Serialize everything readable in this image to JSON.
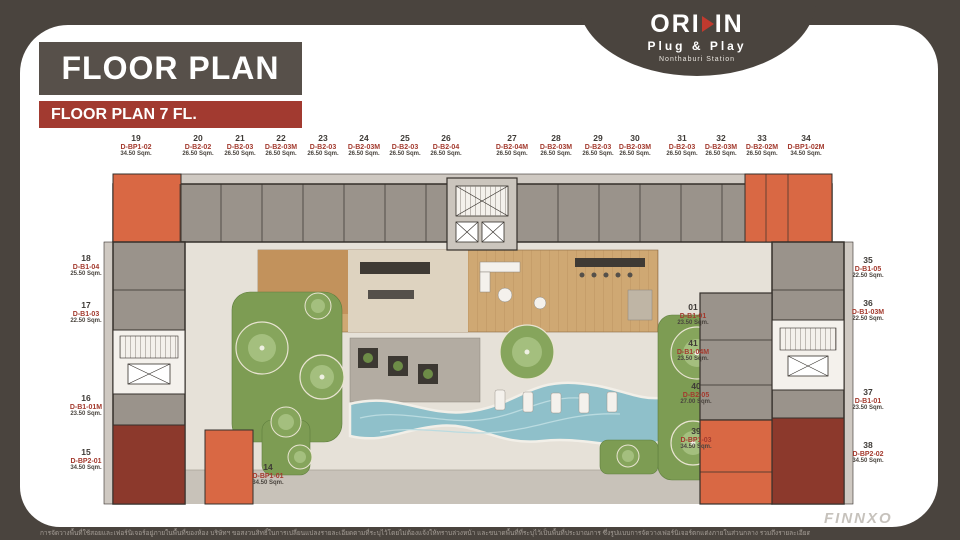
{
  "header": {
    "title": "FLOOR PLAN",
    "subtitle": "FLOOR PLAN 7 FL."
  },
  "logo": {
    "name_left": "ORI",
    "name_right": "IN",
    "play_icon": "play-triangle",
    "tagline": "Plug & Play",
    "station": "Nonthaburi Station"
  },
  "plan": {
    "top_units": [
      {
        "no": "19",
        "type": "D-BP1-02",
        "area": "34.50 Sqm."
      },
      {
        "no": "20",
        "type": "D-B2-02",
        "area": "26.50 Sqm."
      },
      {
        "no": "21",
        "type": "D-B2-03",
        "area": "26.50 Sqm."
      },
      {
        "no": "22",
        "type": "D-B2-03M",
        "area": "26.50 Sqm."
      },
      {
        "no": "23",
        "type": "D-B2-03",
        "area": "26.50 Sqm."
      },
      {
        "no": "24",
        "type": "D-B2-03M",
        "area": "26.50 Sqm."
      },
      {
        "no": "25",
        "type": "D-B2-03",
        "area": "26.50 Sqm."
      },
      {
        "no": "26",
        "type": "D-B2-04",
        "area": "26.50 Sqm."
      },
      {
        "no": "27",
        "type": "D-B2-04M",
        "area": "26.50 Sqm."
      },
      {
        "no": "28",
        "type": "D-B2-03M",
        "area": "26.50 Sqm."
      },
      {
        "no": "29",
        "type": "D-B2-03",
        "area": "26.50 Sqm."
      },
      {
        "no": "30",
        "type": "D-B2-03M",
        "area": "26.50 Sqm."
      },
      {
        "no": "31",
        "type": "D-B2-03",
        "area": "26.50 Sqm."
      },
      {
        "no": "32",
        "type": "D-B2-03M",
        "area": "26.50 Sqm."
      },
      {
        "no": "33",
        "type": "D-B2-02M",
        "area": "26.50 Sqm."
      },
      {
        "no": "34",
        "type": "D-BP1-02M",
        "area": "34.50 Sqm."
      }
    ],
    "left_units": [
      {
        "no": "18",
        "type": "D-B1-04",
        "area": "25.50 Sqm."
      },
      {
        "no": "17",
        "type": "D-B1-03",
        "area": "22.50 Sqm."
      },
      {
        "no": "16",
        "type": "D-B1-01M",
        "area": "23.50 Sqm."
      },
      {
        "no": "15",
        "type": "D-BP2-01",
        "area": "34.50 Sqm."
      }
    ],
    "right_units": [
      {
        "no": "35",
        "type": "D-B1-05",
        "area": "22.50 Sqm."
      },
      {
        "no": "36",
        "type": "D-B1-03M",
        "area": "22.50 Sqm."
      },
      {
        "no": "37",
        "type": "D-B1-01",
        "area": "23.50 Sqm."
      },
      {
        "no": "38",
        "type": "D-BP2-02",
        "area": "34.50 Sqm."
      }
    ],
    "center_units": [
      {
        "no": "01",
        "type": "D-B1-01",
        "area": "23.50 Sqm."
      },
      {
        "no": "41",
        "type": "D-B1-04M",
        "area": "23.50 Sqm."
      },
      {
        "no": "40",
        "type": "D-B2-05",
        "area": "27.00 Sqm."
      },
      {
        "no": "39",
        "type": "D-BP1-03",
        "area": "34.50 Sqm."
      }
    ],
    "bottom_units": [
      {
        "no": "14",
        "type": "D-BP1-01",
        "area": "34.50 Sqm."
      }
    ]
  },
  "footer": {
    "disclaimer": "การจัดวางพื้นที่ใช้สอยและเฟอร์นิเจอร์อยู่ภายในพื้นที่ของห้อง บริษัทฯ ขอสงวนสิทธิ์ในการเปลี่ยนแปลงรายละเอียดตามที่ระบุไว้โดยไม่ต้องแจ้งให้ทราบล่วงหน้า และขนาดพื้นที่ที่ระบุไว้เป็นพื้นที่ประมาณการ ซึ่งรูปแบบการจัดวางเฟอร์นิเจอร์ตกแต่งภายในส่วนกลาง รวมถึงรายละเอียดต่างๆ เป็นเพียงภาพแสดงตัวอย่างการจัดวางพื้นที่ใช้สอยเท่านั้น",
    "watermark": "FINNXO"
  },
  "colors": {
    "frame": "#4a443e",
    "header_box": "#57504a",
    "accent_red": "#a23a30",
    "unit_gray": "#9a938b",
    "unit_orange": "#d96844",
    "unit_dark_red": "#8c392c",
    "garden_green": "#7d9c53",
    "pool_teal": "#8fc0ca",
    "deck_wood": "#cfa873"
  }
}
